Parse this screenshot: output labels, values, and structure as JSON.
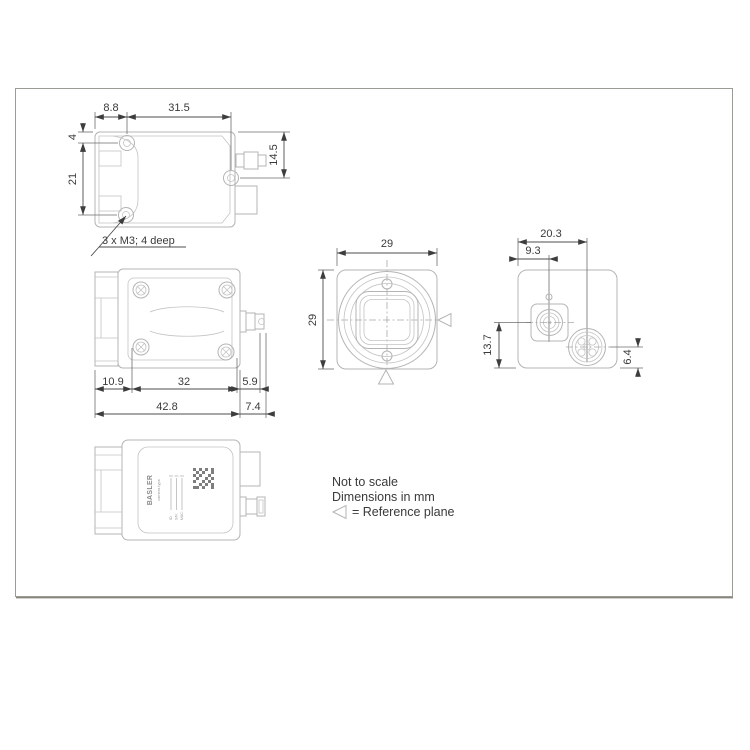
{
  "notes": {
    "scale": "Not to scale",
    "units": "Dimensions in mm",
    "reference_plane": "= Reference plane"
  },
  "top_view": {
    "screw_to_edge": "8.8",
    "screw_to_screw_x": "31.5",
    "edge_to_screw_y": "4",
    "screw_spacing_y": "21",
    "connector_center": "14.5",
    "thread_note": "3 x M3; 4 deep"
  },
  "side_view": {
    "front_length": "10.9",
    "mount_spacing": "32",
    "connector_length": "5.9",
    "body_length": "42.8",
    "connector_total": "7.4"
  },
  "front_view": {
    "width": "29",
    "height": "29"
  },
  "back_view": {
    "connector_center_x": "20.3",
    "power_center_x": "9.3",
    "power_center_y": "13.7",
    "connector_center_y": "6.4"
  },
  "label_view": {
    "brand": "BASLER",
    "camera_type": "camera type",
    "id_label": "ID:",
    "sn_label": "S/N:",
    "mac_label": "MAC:"
  },
  "colors": {
    "outline": "#b4b4b4",
    "dimension": "#4d4d4d",
    "text": "#3a3a3a",
    "frame": "#9c9c96"
  }
}
